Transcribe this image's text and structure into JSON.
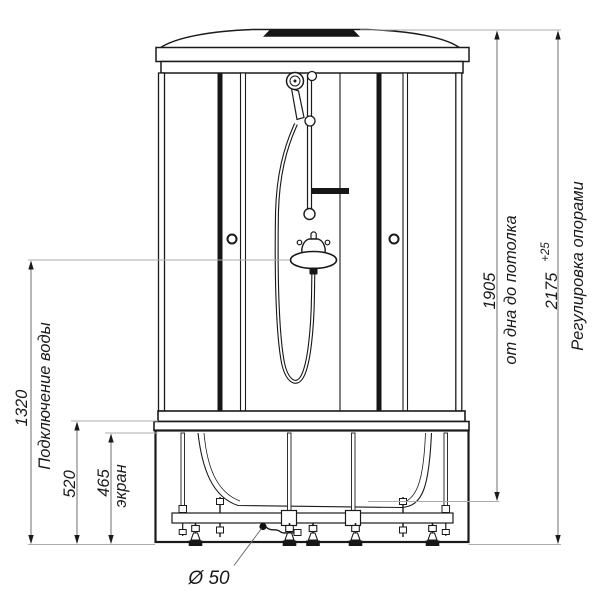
{
  "drawing": {
    "title": "shower-cabin-front-view",
    "dimensions": {
      "water_connection": {
        "value": "1320",
        "label": "Подключение воды"
      },
      "tray_height": {
        "value": "520"
      },
      "screen_height": {
        "value": "465",
        "label": "экран"
      },
      "floor_to_ceiling": {
        "value": "1905",
        "label": "от дна до потолка"
      },
      "total_height": {
        "value": "2175",
        "tolerance": "+25",
        "label": "Регулировка опорами"
      },
      "drain": {
        "value": "Ø 50"
      }
    }
  }
}
